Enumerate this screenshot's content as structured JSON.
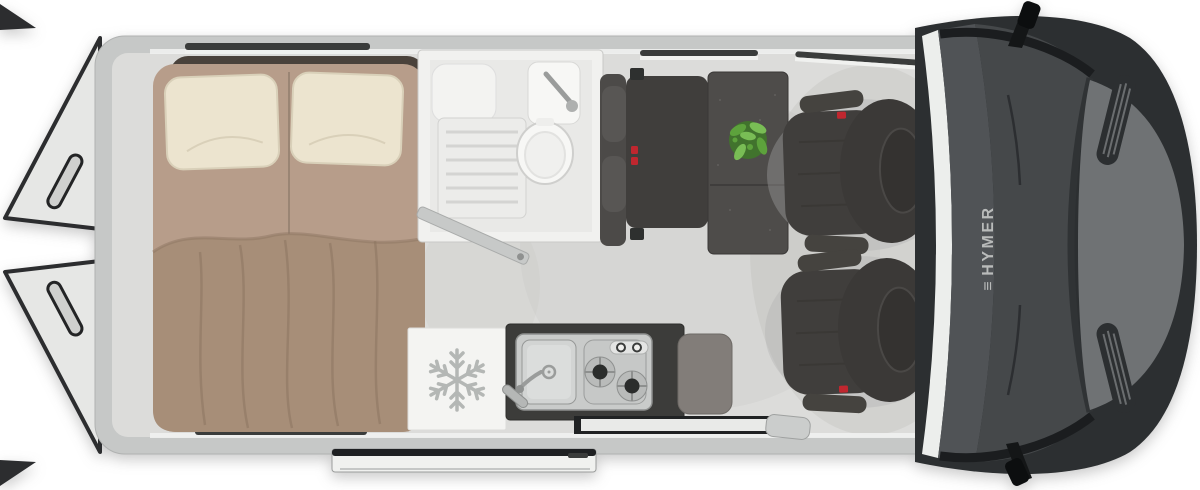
{
  "image_type": "campervan-floorplan-top-view",
  "brand": {
    "logo_mark": "≡",
    "logo_text": "HYMER"
  },
  "features": [
    "rear-doors-open",
    "double-bed-with-two-pillows-and-blanket",
    "bathroom-with-shower-toilet-sink",
    "bench-seat-with-headrests-and-seatbelts",
    "dining-table-with-green-plant",
    "two-swivel-cab-seats",
    "kitchen-unit-sink-and-two-burner-stove",
    "refrigerator-with-snowflake-symbol",
    "open-sliding-entry-door",
    "driver-cab-windshield-hood-mirrors"
  ],
  "icons": {
    "snowflake": "❄"
  },
  "palette": {
    "body-wall": "#c6c8c7",
    "floor": "#dcdcda",
    "door-panel": "#e6e7e5",
    "door-outline": "#2c2d2f",
    "window-slit": "#3a3c3b",
    "sill": "#f0f1ef",
    "headboard": "#4a423b",
    "mattress": "#b79d8a",
    "mattress-seam": "#94806f",
    "pillow": "#ece4cf",
    "pillow-edge": "#d9d0b9",
    "blanket": "#a78e78",
    "blanket-fold": "#8d7662",
    "bath-wall": "#f1f1ef",
    "bath-floor": "#e9e9e7",
    "shower-tray": "#ececea",
    "shower-ridge": "#d4d4d2",
    "porcelain": "#f7f7f5",
    "fixture-edge": "#cfcfcd",
    "chrome": "#9a9c9b",
    "upholstery": "#403e3c",
    "upholstery-light": "#4c4a48",
    "upholstery-dark": "#343230",
    "table": "#4e4c4a",
    "plant": "#5da23c",
    "plant-dark": "#3f7a28",
    "plant-light": "#79bd55",
    "accent-red": "#c0272f",
    "fridge": "#f4f4f2",
    "snowflake": "#b4b7b5",
    "counter": "#3c3c3a",
    "counter-side": "#827d79",
    "steel": "#c9cbca",
    "steel-dark": "#8e908f",
    "burner": "#2b2d2c",
    "cab-trim": "#eceeec",
    "dashboard": "#505356",
    "windshield": "#45484a",
    "windshield-dark": "#303335",
    "hood": "#6f7274",
    "hood-edge": "#2c2f31",
    "mirror-black": "#141617",
    "logo-gray": "#b9bbba",
    "slide-door": "#f0f1ef",
    "slide-door-edge": "#1e2022"
  }
}
